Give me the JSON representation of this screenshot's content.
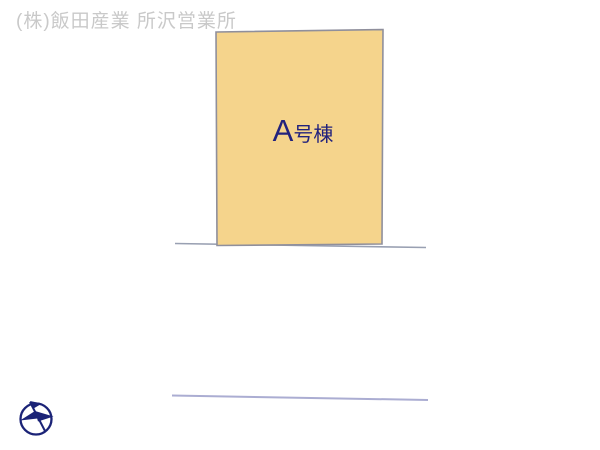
{
  "watermark": {
    "text": "(株)飯田産業 所沢営業所",
    "color": "#c9c9c9"
  },
  "site_plan": {
    "building": {
      "label": "A号棟",
      "label_main": "A",
      "label_sub": "号棟",
      "fill_color": "#f5d48c",
      "border_color": "#8f8f9c",
      "label_color": "#22227d"
    },
    "boundary_lines": {
      "upper_color": "#99a0b2",
      "lower_color": "#abadd2"
    },
    "compass": {
      "icon": "north-arrow-compass",
      "color": "#1b2377"
    }
  }
}
